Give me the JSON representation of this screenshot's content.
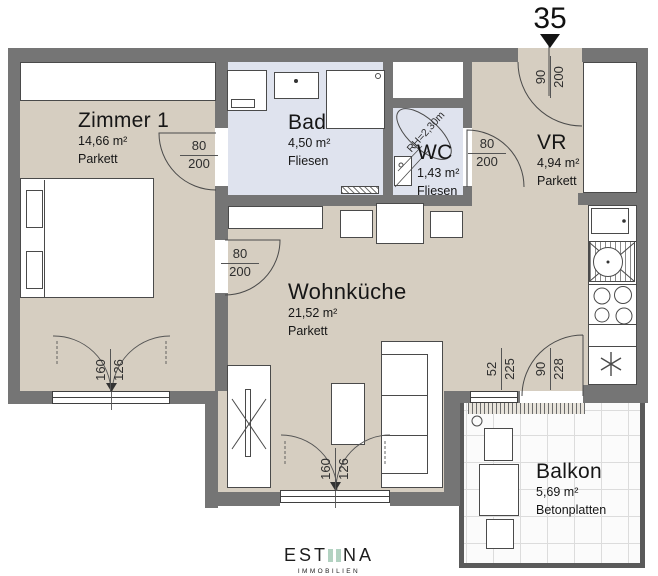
{
  "unit": {
    "number": "35"
  },
  "rooms": {
    "zimmer1": {
      "name": "Zimmer 1",
      "area": "14,66 m²",
      "floor": "Parkett"
    },
    "bad": {
      "name": "Bad",
      "area": "4,50 m²",
      "floor": "Fliesen"
    },
    "wc": {
      "name": "WC",
      "area": "1,43 m²",
      "floor": "Fliesen",
      "room_height": "RH=2,30m"
    },
    "vr": {
      "name": "VR",
      "area": "4,94 m²",
      "floor": "Parkett"
    },
    "wohnkueche": {
      "name": "Wohnküche",
      "area": "21,52 m²",
      "floor": "Parkett"
    },
    "balkon": {
      "name": "Balkon",
      "area": "5,69 m²",
      "floor": "Betonplatten"
    }
  },
  "dimensions": {
    "door_zimmer1_bad": {
      "width": "80",
      "height": "200"
    },
    "door_zimmer1_wohnkueche": {
      "width": "80",
      "height": "200"
    },
    "door_wc": {
      "width": "80",
      "height": "200"
    },
    "entry_door": {
      "width": "90",
      "height": "200"
    },
    "window_zimmer1": {
      "width": "160",
      "height": "126"
    },
    "window_wohnkueche": {
      "width": "160",
      "height": "126"
    },
    "balcony_window": {
      "width": "52",
      "height": "225"
    },
    "balcony_door": {
      "width": "90",
      "height": "228"
    }
  },
  "logo": {
    "prefix": "EST",
    "suffix": "NA",
    "subtitle": "IMMOBILIEN"
  },
  "colors": {
    "wall": "#757575",
    "floor_wood": "#d6cec1",
    "floor_tile": "#dfe3ee",
    "balcony_floor": "#fbfbfb",
    "line": "#4a4a4a",
    "logo_green": "#b2d2c1"
  }
}
